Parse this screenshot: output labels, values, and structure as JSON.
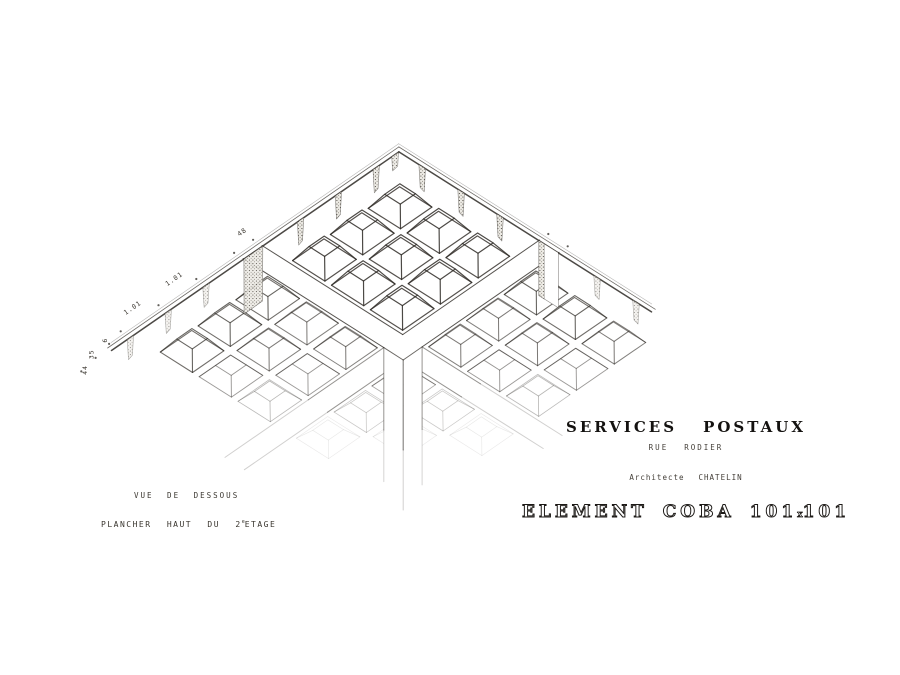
{
  "sheet": {
    "background": "#ffffff",
    "ink": "#2d2924"
  },
  "captions": {
    "view": "VUE DE DESSOUS",
    "floor_prefix": "PLANCHER HAUT DU 2",
    "floor_sup": "e",
    "floor_suffix": "ETAGE"
  },
  "titleblock": {
    "project_line": [
      "SERVICES",
      "POSTAUX"
    ],
    "address_line": [
      "RUE",
      "RODIER"
    ],
    "architect_line": [
      "Architecte",
      "CHATELIN"
    ],
    "element_line": [
      "ELEMENT",
      "COBA",
      "101",
      "x",
      "101"
    ]
  },
  "dimensions": {
    "edge_modules": [
      "1.01",
      "1.01"
    ],
    "beam_width": "48",
    "section_chain": [
      "6",
      "35",
      "44"
    ]
  },
  "geometry": {
    "apex": {
      "x": 399,
      "y": 157
    },
    "pitch": 46,
    "u_axis": {
      "x": 0.845,
      "y": 0.535
    },
    "v_axis": {
      "x": -0.822,
      "y": 0.568
    },
    "near_cells": [
      0.5,
      1.5,
      2.5
    ],
    "far_cells": [
      4.0,
      5.0,
      6.0
    ],
    "beam": {
      "start": 3.5,
      "end": 4.0
    },
    "beam_far_u": 7.6,
    "beam_far_v": 8.2,
    "rib_inset": 0.085,
    "dome_inset": 0.3,
    "dome_height": 15,
    "left_edge_len": 7.5,
    "right_edge_len": 6.4,
    "column_height": 150,
    "left_tabs": [
      0.5,
      1.5,
      2.5,
      5.0,
      6.0,
      7.0
    ],
    "right_tabs": [
      0.5,
      1.5,
      2.5,
      5.0,
      6.0
    ],
    "left_dots": [
      [
        -0.35,
        3.5
      ],
      [
        -0.35,
        4.0
      ],
      [
        -0.35,
        5.0
      ],
      [
        -0.35,
        6.0
      ],
      [
        -0.35,
        7.0
      ],
      [
        -0.26,
        7.4
      ],
      [
        -0.17,
        7.85
      ],
      [
        -0.1,
        8.3
      ]
    ],
    "right_dots": [
      [
        3.5,
        -0.35
      ],
      [
        4.0,
        -0.35
      ]
    ],
    "module_label_pos": [
      [
        -0.6,
        5.3
      ],
      [
        -0.6,
        6.4
      ]
    ],
    "beam_label_pos": [
      -0.6,
      3.5
    ],
    "chain_pos": [
      [
        -0.36,
        7.35
      ],
      [
        -0.27,
        7.8
      ],
      [
        -0.05,
        8.2
      ]
    ],
    "edge_text_angle": -34.6
  }
}
